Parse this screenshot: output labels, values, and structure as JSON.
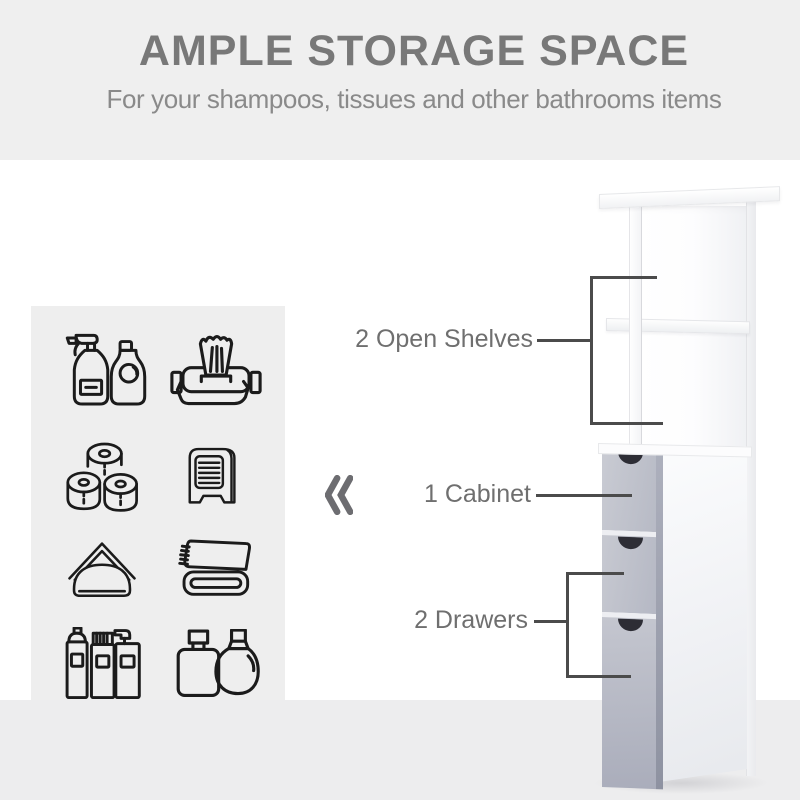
{
  "header": {
    "title": "AMPLE STORAGE SPACE",
    "subtitle": "For your shampoos, tissues and other bathrooms items"
  },
  "callouts": {
    "open_shelves": "2 Open Shelves",
    "cabinet": "1 Cabinet",
    "drawers": "2 Drawers"
  },
  "icon_panel": {
    "items": [
      "spray-bottle-and-soap-icon",
      "wet-wipes-icon",
      "toilet-paper-rolls-icon",
      "napkin-dispenser-icon",
      "napkin-holder-icon",
      "folded-towel-icon",
      "toiletry-bottles-icon",
      "perfume-bottles-icon"
    ]
  },
  "decor": {
    "chevron_glyph": "«"
  },
  "colors": {
    "band_gray": "#efefef",
    "floor_gray": "#ededee",
    "panel_gray": "#eeeeee",
    "title_gray": "#787878",
    "subtitle_gray": "#8a8a8a",
    "label_gray": "#6f6f6f",
    "line_gray": "#4b4b4b",
    "icon_stroke": "#1b1b1b",
    "drawer_front": "#b9bcc8",
    "drawer_edge": "#979baa",
    "handle_notch": "#2d2d35",
    "chevron_gray": "#6d6d71"
  }
}
